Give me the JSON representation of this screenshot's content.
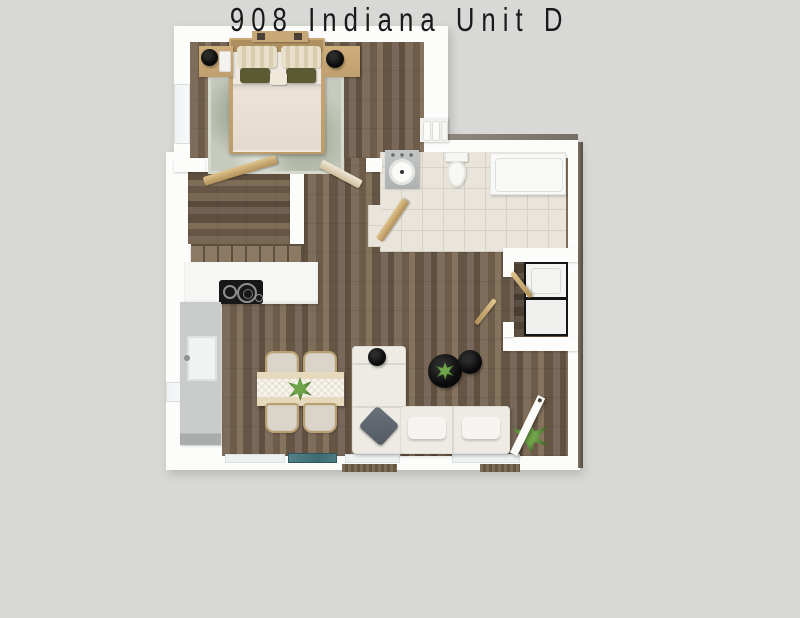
{
  "caption": {
    "text": "908 Indiana Unit D",
    "color": "#1a1a1a"
  },
  "scene": {
    "kind": "3d-floor-plan-top-view",
    "background_color": "#d8d9d6",
    "wall_color": "#fcfcfb",
    "wood_floor_color": "#746453",
    "tile_floor_color": "#e9e5dc",
    "rooms": [
      {
        "name": "Bedroom",
        "floor": "wood",
        "features": [
          "double-bed",
          "headboard-shelf",
          "striped-pillows",
          "olive-accent-pillows",
          "area-rug",
          "nightstand-left",
          "nightstand-right",
          "black-table-lamps",
          "left-wall-window",
          "two-swing-doors"
        ]
      },
      {
        "name": "Closet",
        "floor": "wood",
        "features": [
          "tan-swing-door",
          "storage-cabinet-row"
        ]
      },
      {
        "name": "Bathroom",
        "floor": "tile",
        "features": [
          "gray-vanity-with-round-sink",
          "toilet",
          "bathtub",
          "tan-swing-door",
          "towel-shelf"
        ]
      },
      {
        "name": "Kitchen",
        "floor": "wood",
        "features": [
          "white-counter",
          "black-cooktop",
          "gray-side-counter",
          "kitchen-sink",
          "left-wall-window"
        ]
      },
      {
        "name": "Living-Dining",
        "floor": "wood",
        "features": [
          "dining-table-with-runner",
          "four-beige-chairs",
          "centerpiece-plant",
          "l-shaped-white-sectional-sofa",
          "gray-throw-pillow",
          "white-throw-pillows",
          "two-round-black-coffee-tables",
          "coffee-table-plant",
          "floor-plant",
          "white-entry-door",
          "bottom-wall-windows",
          "teal-glass-window",
          "exterior-door-mats"
        ]
      },
      {
        "name": "Laundry Nook",
        "floor": "wood",
        "features": [
          "stacked-washer-dryer",
          "bifold-chevron-doors"
        ]
      }
    ]
  }
}
